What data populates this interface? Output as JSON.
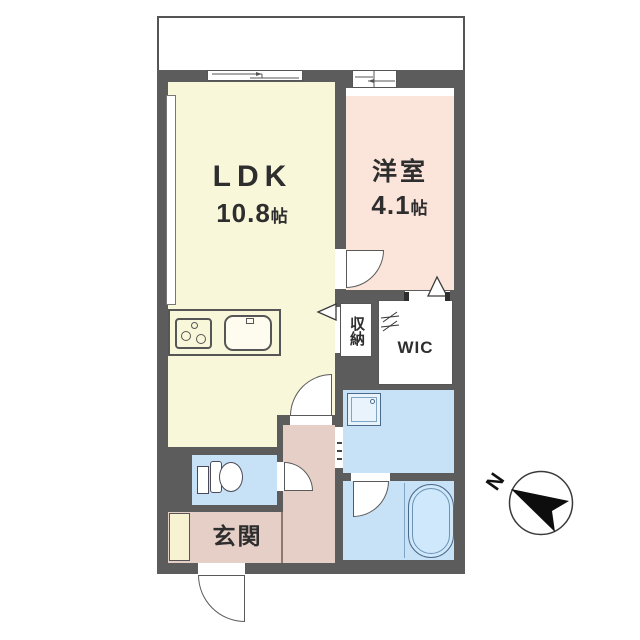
{
  "rooms": {
    "ldk": {
      "label": "LDK",
      "area": "10.8",
      "unit": "帖"
    },
    "western": {
      "label": "洋室",
      "area": "4.1",
      "unit": "帖"
    },
    "closet": {
      "label": "収納"
    },
    "wic": {
      "label": "WIC"
    },
    "entrance": {
      "label": "玄関"
    }
  },
  "compass": {
    "north_label": "N"
  },
  "colors": {
    "wall": "#5c5c5c",
    "ldk": "#f9f7d9",
    "bedroom": "#fbe4da",
    "hall": "#e6cfc7",
    "water": "#c7e2f7",
    "white": "#ffffff",
    "cabinet": "#f7f3d2"
  }
}
